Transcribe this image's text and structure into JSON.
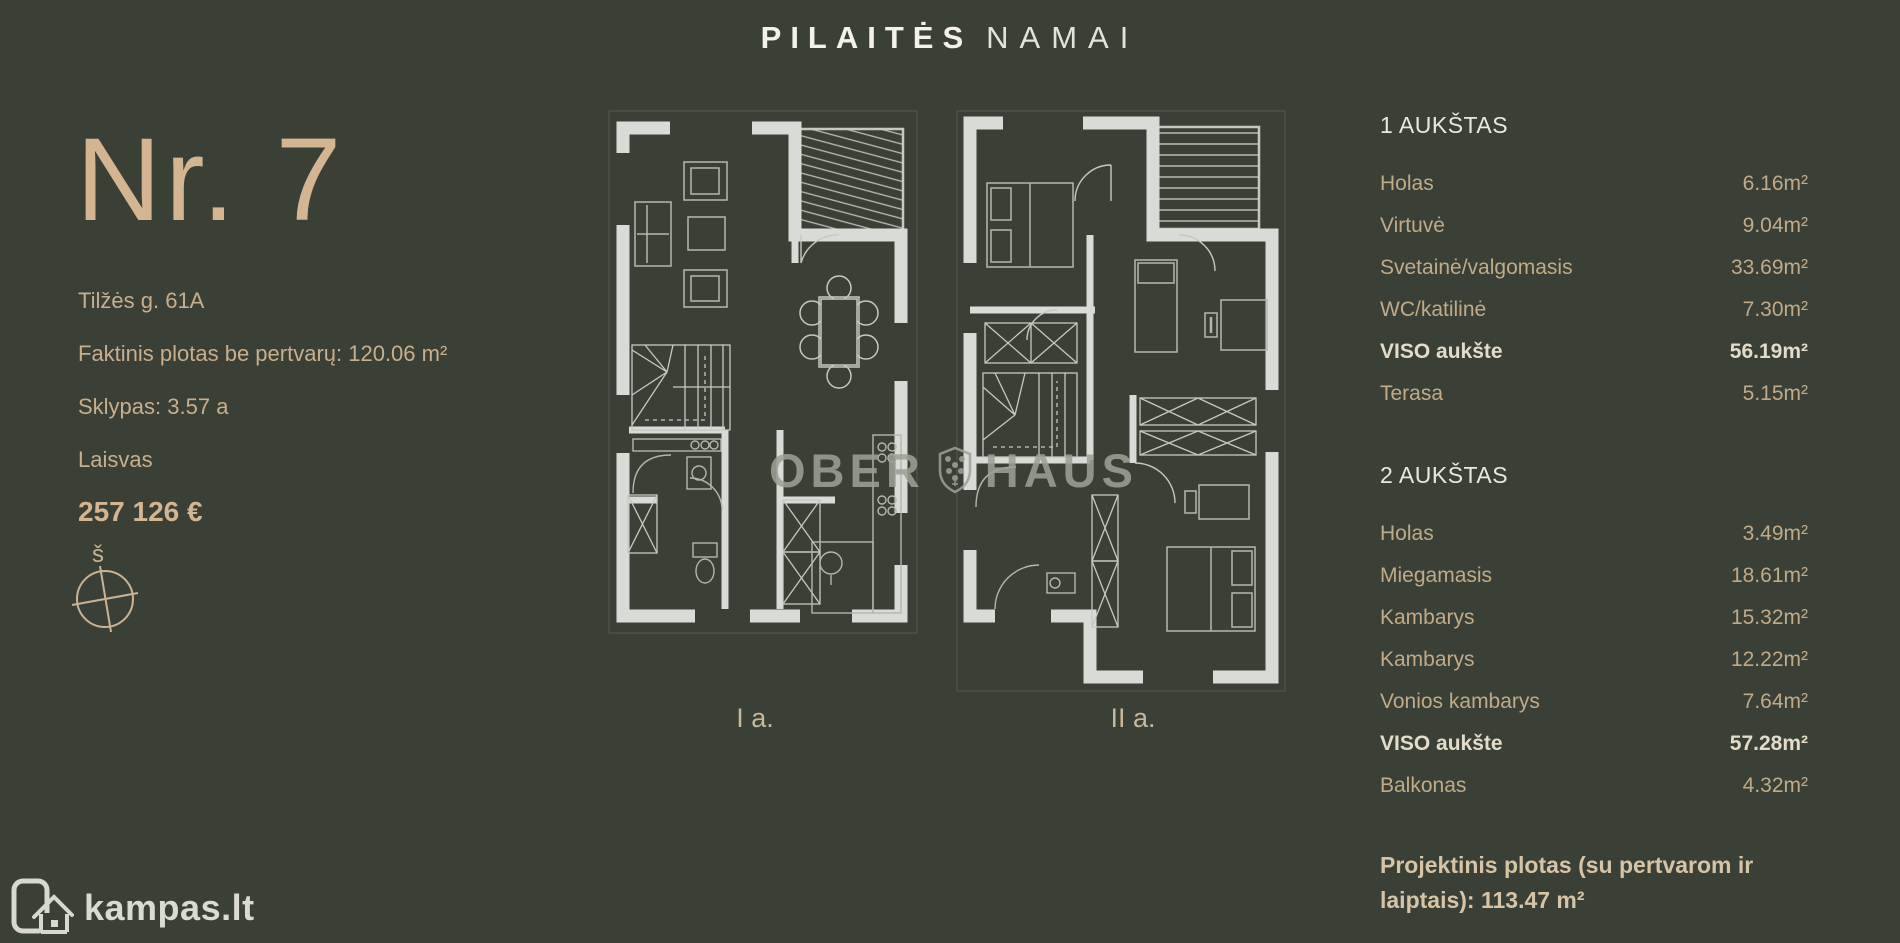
{
  "header": {
    "brand_primary": "PILAITĖS",
    "brand_secondary": "NAMAI"
  },
  "listing": {
    "number": "Nr. 7",
    "address": "Tilžės g. 61A",
    "area_line": "Faktinis plotas be pertvarų: 120.06 m²",
    "plot_line": "Sklypas: 3.57 a",
    "status": "Laisvas",
    "price": "257 126 €",
    "compass_north": "š"
  },
  "plans": {
    "floor1_label": "I a.",
    "floor2_label": "II a.",
    "watermark_left": "OBER",
    "watermark_right": "HAUS"
  },
  "floors": [
    {
      "title": "1 AUKŠTAS",
      "rows": [
        {
          "label": "Holas",
          "value": "6.16m²"
        },
        {
          "label": "Virtuvė",
          "value": "9.04m²"
        },
        {
          "label": "Svetainė/valgomasis",
          "value": "33.69m²"
        },
        {
          "label": "WC/katilinė",
          "value": "7.30m²"
        },
        {
          "label": "VISO aukšte",
          "value": "56.19m²"
        },
        {
          "label": "Terasa",
          "value": "5.15m²"
        }
      ]
    },
    {
      "title": "2 AUKŠTAS",
      "rows": [
        {
          "label": "Holas",
          "value": "3.49m²"
        },
        {
          "label": "Miegamasis",
          "value": "18.61m²"
        },
        {
          "label": "Kambarys",
          "value": "15.32m²"
        },
        {
          "label": "Kambarys",
          "value": "12.22m²"
        },
        {
          "label": "Vonios kambarys",
          "value": "7.64m²"
        },
        {
          "label": "VISO aukšte",
          "value": "57.28m²"
        },
        {
          "label": "Balkonas",
          "value": "4.32m²"
        }
      ]
    }
  ],
  "summary": {
    "text": "Projektinis plotas (su pertvarom ir laiptais): 113.47 m²"
  },
  "footer": {
    "logo_text": "kampas.lt"
  },
  "colors": {
    "background": "#3b4036",
    "accent_beige": "#d3b591",
    "wall_light": "#d9dbd6",
    "heading_white": "#eae8de",
    "watermark_gray": "#9c9f94"
  }
}
